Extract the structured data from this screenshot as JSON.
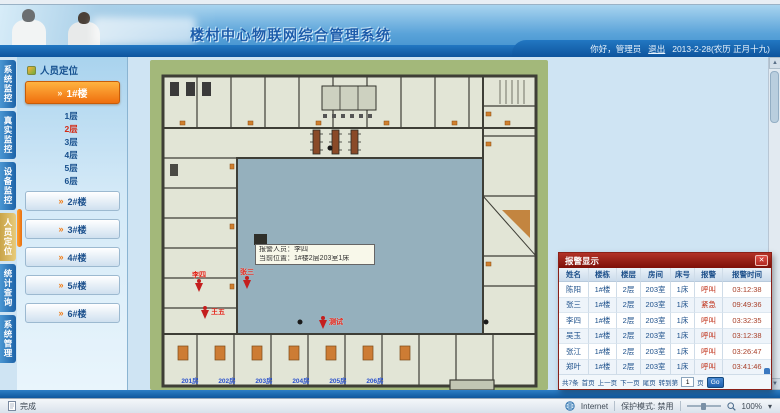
{
  "header": {
    "title": "楼村中心物联网综合管理系统",
    "greeting": "你好，管理员",
    "logout_label": "退出",
    "date_text": "2013-2-28(农历 正月十九)"
  },
  "nav": {
    "tabs": [
      {
        "label": "系统监控"
      },
      {
        "label": "真实监控"
      },
      {
        "label": "设备监控"
      },
      {
        "label": "人员定位",
        "active": true
      },
      {
        "label": "统计查询"
      },
      {
        "label": "系统管理"
      }
    ]
  },
  "sidebar": {
    "panel_title": "人员定位",
    "buildings": [
      "1#楼",
      "2#楼",
      "3#楼",
      "4#楼",
      "5#楼",
      "6#楼"
    ],
    "floors": [
      "1层",
      "2层",
      "3层",
      "4层",
      "5层",
      "6层"
    ],
    "current_floor": "2层"
  },
  "plan": {
    "tooltip_line1": "报警人员：李四",
    "tooltip_line2": "当前位置：1#楼2层203室1床",
    "markers": [
      {
        "name": "李四"
      },
      {
        "name": "张三"
      },
      {
        "name": "王五"
      },
      {
        "name": "测试"
      }
    ],
    "room_labels": [
      "201房",
      "202房",
      "203房",
      "204房",
      "205房",
      "206房"
    ]
  },
  "alarm": {
    "title": "报警显示",
    "columns": [
      "姓名",
      "楼栋",
      "楼层",
      "房间",
      "床号",
      "报警",
      "报警时间"
    ],
    "rows": [
      [
        "陈阳",
        "1#楼",
        "2层",
        "203室",
        "1床",
        "呼叫",
        "03:12:38"
      ],
      [
        "张三",
        "1#楼",
        "2层",
        "203室",
        "1床",
        "紧急",
        "09:49:36"
      ],
      [
        "李四",
        "1#楼",
        "2层",
        "203室",
        "1床",
        "呼叫",
        "03:32:35"
      ],
      [
        "吴玉",
        "1#楼",
        "2层",
        "203室",
        "1床",
        "呼叫",
        "03:12:38"
      ],
      [
        "张江",
        "1#楼",
        "2层",
        "203室",
        "1床",
        "呼叫",
        "03:26:47"
      ],
      [
        "郑叶",
        "1#楼",
        "2层",
        "203室",
        "1床",
        "呼叫",
        "03:41:46"
      ]
    ],
    "pagination": {
      "total": "共7条",
      "first": "首页",
      "prev": "上一页",
      "next": "下一页",
      "last": "尾页",
      "goto_prefix": "转到第",
      "page": "1",
      "goto_suffix": "页",
      "go": "Go"
    }
  },
  "statusbar": {
    "done": "完成",
    "zone": "Internet",
    "protected_mode": "保护模式: 禁用",
    "zoom": "100%"
  },
  "icons": {
    "arrow": "»",
    "close": "✕",
    "up": "▲",
    "down": "▼",
    "dropdown": "▾"
  },
  "colors": {
    "accent_orange": "#f07a12",
    "alarm_red": "#a01810",
    "header_blue": "#1a6ab5",
    "link_yellow": "#ffd24a"
  }
}
